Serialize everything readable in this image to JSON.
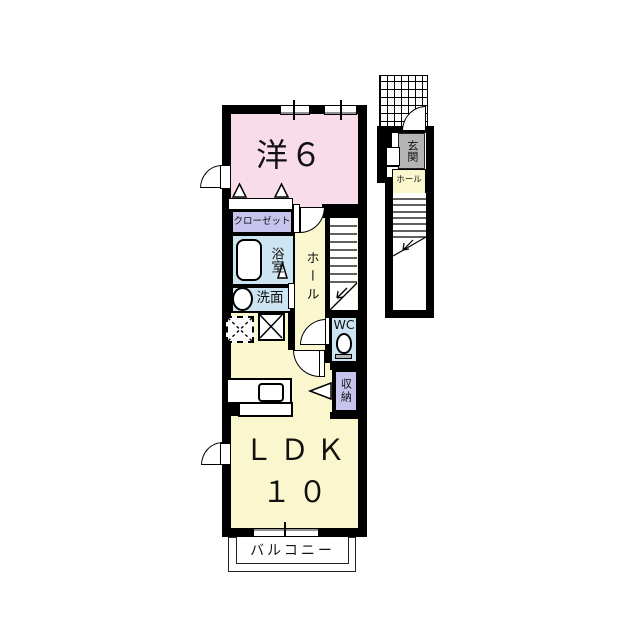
{
  "floorplan": {
    "rooms": {
      "western": {
        "label": "洋６"
      },
      "closet": {
        "label": "クローゼット"
      },
      "bath": {
        "label": "浴室"
      },
      "wash": {
        "label": "洗面"
      },
      "hall": {
        "label": "ホール"
      },
      "wc": {
        "label": "WC"
      },
      "storage": {
        "label": "収納"
      },
      "ldk": {
        "label": "ＬＤＫ",
        "size": "１０"
      },
      "balcony": {
        "label": "バルコニー"
      },
      "genkan": {
        "label": "玄関"
      },
      "genkan_hall": {
        "label": "ホール"
      }
    },
    "colors": {
      "wall": "#000000",
      "western_room": "#f8dce9",
      "living": "#faf6cd",
      "wet_area": "#cde4f3",
      "storage_area": "#c6c3ec",
      "genkan": "#b4b4b4"
    },
    "icons": [
      "bathtub-icon",
      "sink-icon",
      "toilet-icon",
      "kitchen-counter-icon",
      "stairs-icon",
      "door-arc-icon",
      "window-icon",
      "washer-space-icon",
      "fridge-space-icon",
      "closet-door-icon",
      "tile-porch-icon",
      "down-arrow-icon",
      "folding-door-arrow-icon"
    ]
  }
}
